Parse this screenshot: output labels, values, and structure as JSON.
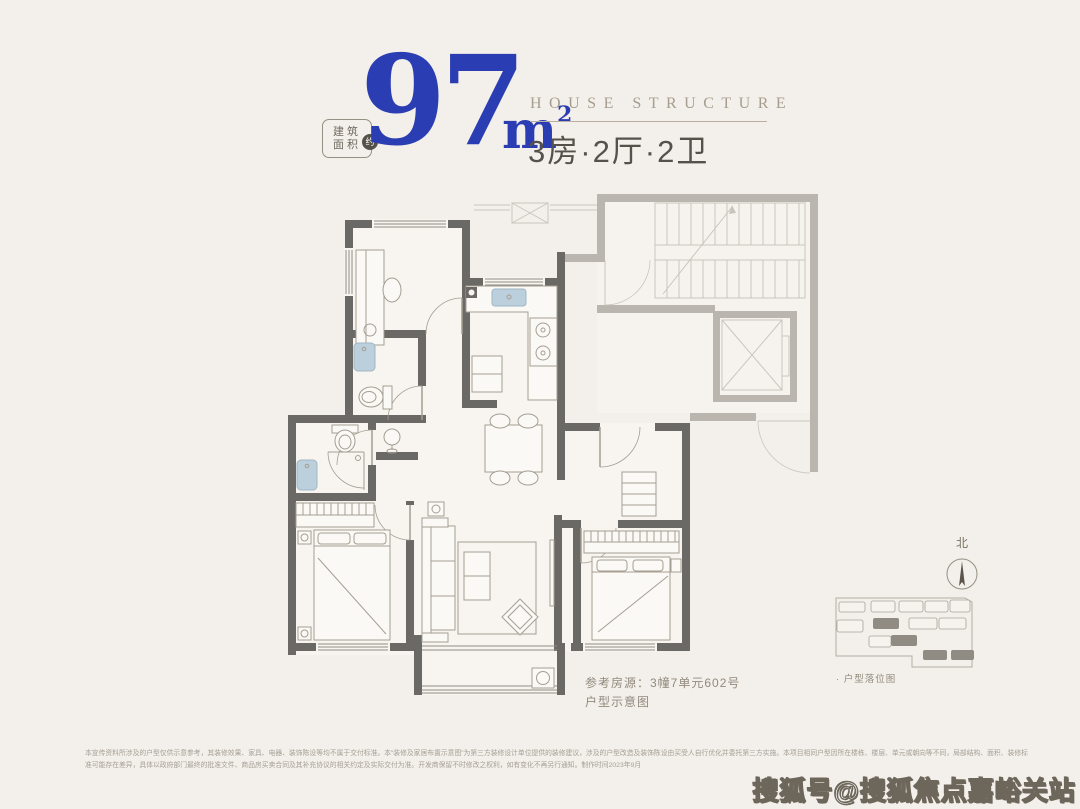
{
  "colors": {
    "bg": "#f3efea",
    "blue": "#2b3db3",
    "entitle": "#a79d8f",
    "rule": "#b9ae9f",
    "cntitle": "#57514b",
    "badge": "#6f6960",
    "badgecircle": "#55504a",
    "wall": "#6b6965",
    "ghost": "#bab6af",
    "ghostline": "#c9c5be",
    "line": "#a49e93",
    "floor": "#f8f5f0",
    "fixture": "#bccfdc",
    "fixturestroke": "#9fb6c5",
    "textgray": "#928a7d",
    "disc": "#a59f95",
    "wmstroke": "#6d665b"
  },
  "header": {
    "badge_line1": "建筑",
    "badge_line2": "面积",
    "badge_approx": "约",
    "area_value": "97",
    "area_unit": "m",
    "area_exp": "2",
    "en_title": "HOUSE STRUCTURE",
    "cn_rooms": "3房·2厅·2卫"
  },
  "plan": {
    "reference_line1": "参考房源：3幢7单元602号",
    "reference_line2": "户型示意图",
    "compass_label": "北",
    "site_caption": "· 户型落位图"
  },
  "footer": {
    "disclaimer_line1": "本宣传资料所涉及的户型仅供示意参考，其装修效果、家具、电器、装饰陈设等均不属于交付标准。本“装修及家居布置示意图”为第三方装修设计单位提供的装修建议，涉及的户型改造及装饰陈设由买受人自行优化并委托第三方实施。本项目相同户型因所在楼栋、楼层、单元或朝向等不同，局部结构、面积、装修标",
    "disclaimer_line2": "准可能存在差异，具体以政府部门最终的批准文件、商品房买卖合同及其补充协议的相关约定及实际交付为准。开发商保留不时修改之权利，如有变化不再另行通知。制作时间2023年9月"
  },
  "watermark": "搜狐号@搜狐焦点嘉峪关站"
}
